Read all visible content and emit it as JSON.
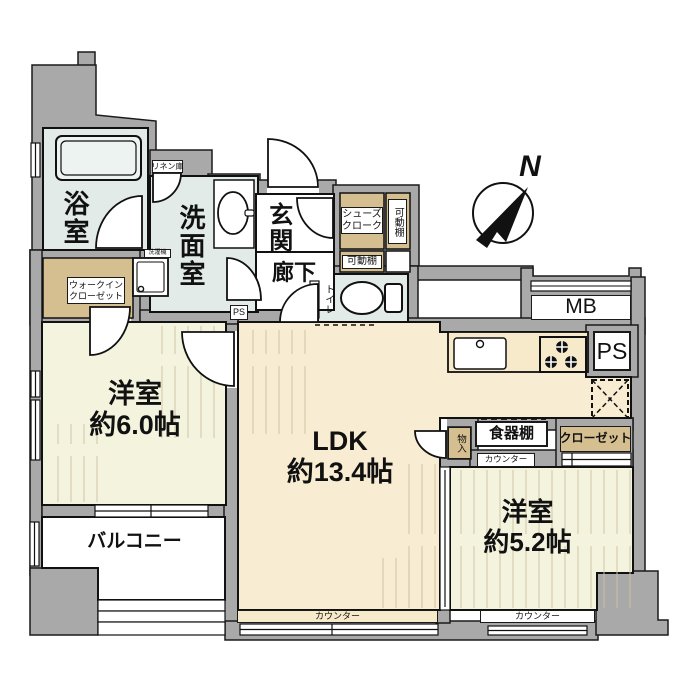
{
  "colors": {
    "wall": "#A9A9A9",
    "outline": "#1a1a1a",
    "ldk_floor": "#F8ECD2",
    "room_floor": "#F4F4DE",
    "wet_floor": "#E2EBE8",
    "closet_tan": "#D5BE8F",
    "counter": "#F7EACB",
    "grain": "#CDC2A4"
  },
  "compass": {
    "north_label": "N"
  },
  "rooms": {
    "bath": {
      "label": "浴室"
    },
    "washroom": {
      "label": "洗面室"
    },
    "entrance": {
      "label": "玄関"
    },
    "corridor": {
      "label": "廊下"
    },
    "toilet": {
      "label": "トイレ"
    },
    "ldk": {
      "label": "LDK",
      "size": "約13.4帖"
    },
    "western_6": {
      "label": "洋室",
      "size": "約6.0帖"
    },
    "western_5_2": {
      "label": "洋室",
      "size": "約5.2帖"
    },
    "balcony": {
      "label": "バルコニー"
    }
  },
  "storage": {
    "walk_in_closet": {
      "line1": "ウォークイン",
      "line2": "クローゼット"
    },
    "linen": {
      "label": "リネン庫"
    },
    "shoe_cloak": {
      "line1": "シューズ",
      "line2": "クローク"
    },
    "movable_shelf_right": {
      "label": "可動棚"
    },
    "movable_shelf_bottom": {
      "label": "可動棚"
    },
    "closet": {
      "label": "クローゼット"
    },
    "monoire": {
      "label": "物入"
    },
    "cupboard": {
      "label": "食器棚"
    }
  },
  "fixtures": {
    "laundry": {
      "label": "洗濯機"
    },
    "meter_box": {
      "label": "MB"
    },
    "pipe_space": {
      "label": "PS"
    },
    "pipe_space_small": {
      "label": "PS"
    }
  },
  "counters": {
    "ldk_bottom": {
      "label": "カウンター"
    },
    "west52_top": {
      "label": "カウンター"
    },
    "west52_bottom": {
      "label": "カウンター"
    }
  }
}
